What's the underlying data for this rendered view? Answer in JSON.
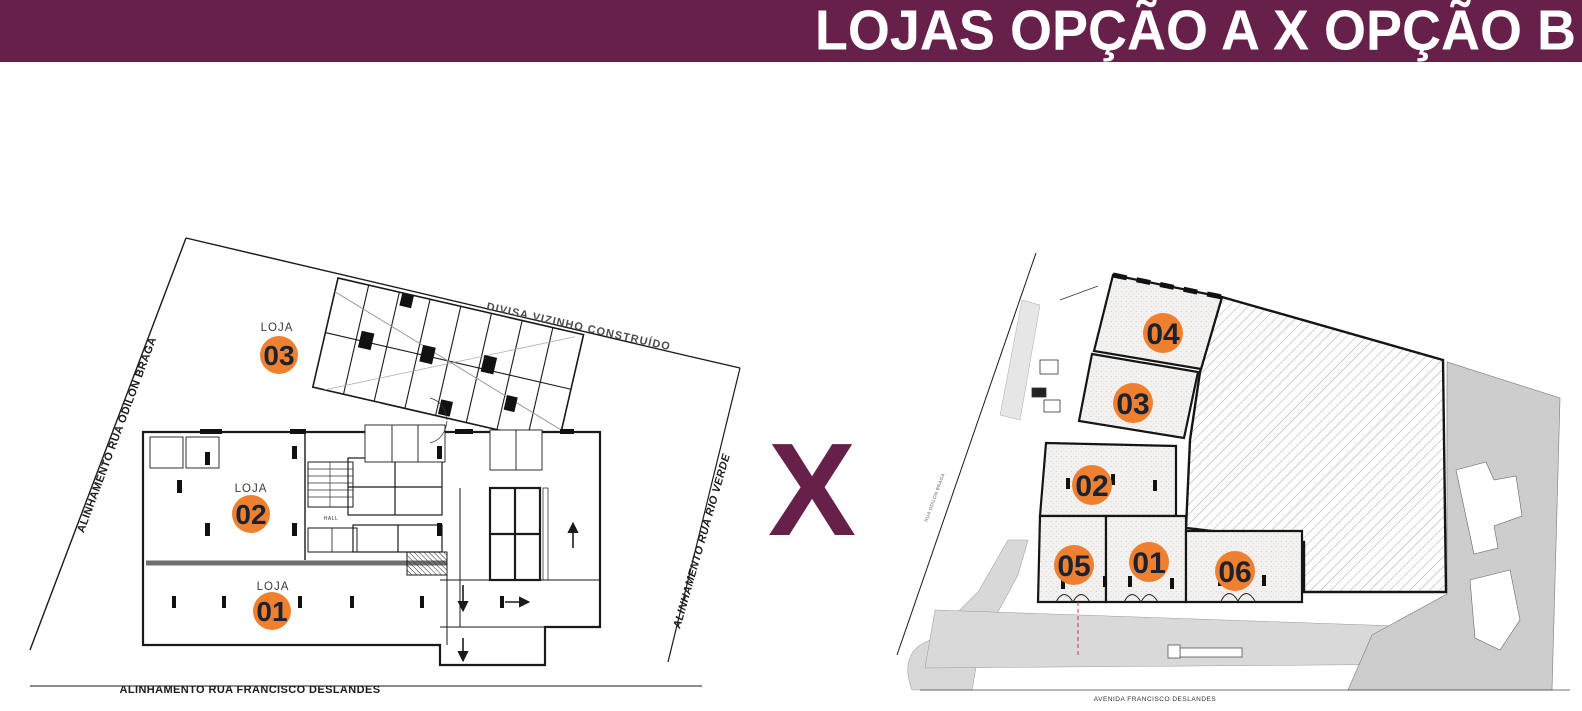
{
  "header": {
    "title": "LOJAS OPÇÃO A X OPÇÃO B"
  },
  "divider": {
    "symbol": "X"
  },
  "plan_a": {
    "name": "Opção A - planta com 3 lojas",
    "streets": {
      "left": "ALINHAMENTO RUA ODILON BRAGA",
      "top": "DIVISA VIZINHO CONSTRUÍDO",
      "right": "ALINHAMENTO RUA RIO VERDE",
      "bottom": "ALINHAMENTO RUA FRANCISCO DESLANDES"
    },
    "hall": "HALL",
    "units": [
      {
        "label": "LOJA",
        "number": "03"
      },
      {
        "label": "LOJA",
        "number": "02"
      },
      {
        "label": "LOJA",
        "number": "01"
      }
    ]
  },
  "plan_b": {
    "name": "Opção B - planta com 6 lojas",
    "streets": {
      "left": "RUA ODILON BRAGA",
      "bottom": "AVENIDA FRANCISCO DESLANDES"
    },
    "units": [
      {
        "number": "04"
      },
      {
        "number": "03"
      },
      {
        "number": "02"
      },
      {
        "number": "05"
      },
      {
        "number": "01"
      },
      {
        "number": "06"
      }
    ]
  },
  "colors": {
    "banner": "#67204A",
    "divider_x": "#67204A",
    "badge": "#EE8030",
    "badge_text": "#1B2330",
    "sidewalk_gray": "#D9D9D9",
    "terrain_gray": "#CDCDCD"
  }
}
